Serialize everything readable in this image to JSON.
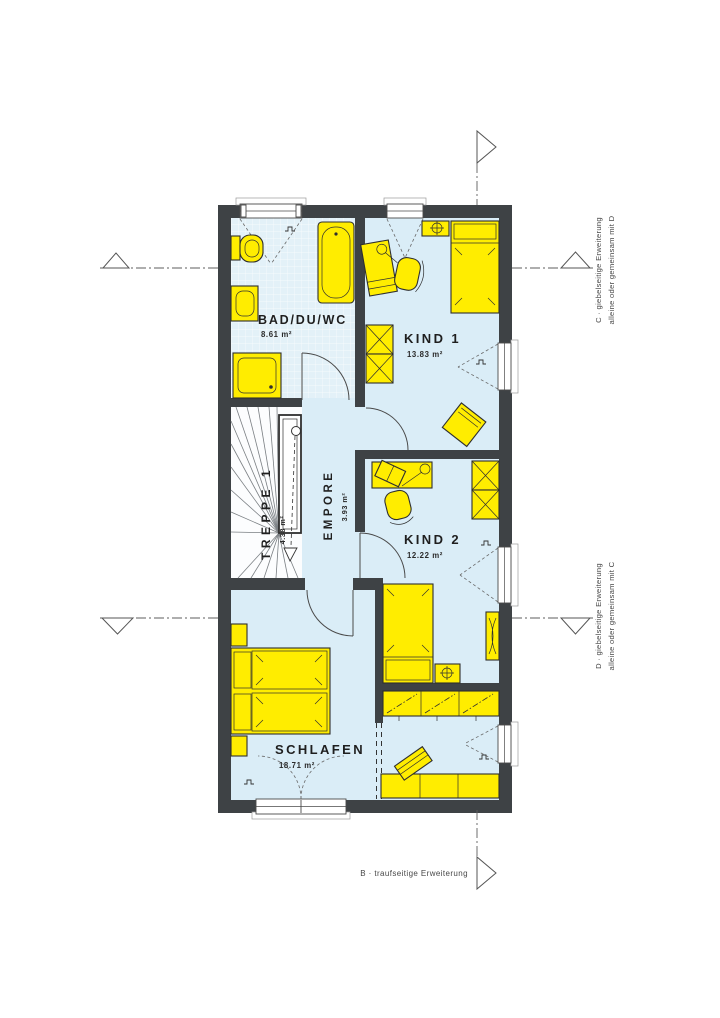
{
  "plan": {
    "rooms": {
      "bad": {
        "name": "BAD/DU/WC",
        "area": "8.61 m²"
      },
      "kind1": {
        "name": "KIND 1",
        "area": "13.83 m²"
      },
      "treppe": {
        "name": "TREPPE 1",
        "area": "4.38 m²"
      },
      "empore": {
        "name": "EMPORE",
        "area": "3.93 m²"
      },
      "kind2": {
        "name": "KIND 2",
        "area": "12.22 m²"
      },
      "schlafen": {
        "name": "SCHLAFEN",
        "area": "18.71 m²"
      }
    },
    "annotations": {
      "c_line1": "C · giebelseitige Erweiterung",
      "c_line2": "alleine oder gemeinsam mit D",
      "d_line1": "D · giebelseitige Erweiterung",
      "d_line2": "alleine oder gemeinsam mit C",
      "b_label": "B · traufseitige Erweiterung"
    },
    "colors": {
      "wall": "#3e4245",
      "floor": "#daedf7",
      "furniture": "#ffed00"
    }
  }
}
